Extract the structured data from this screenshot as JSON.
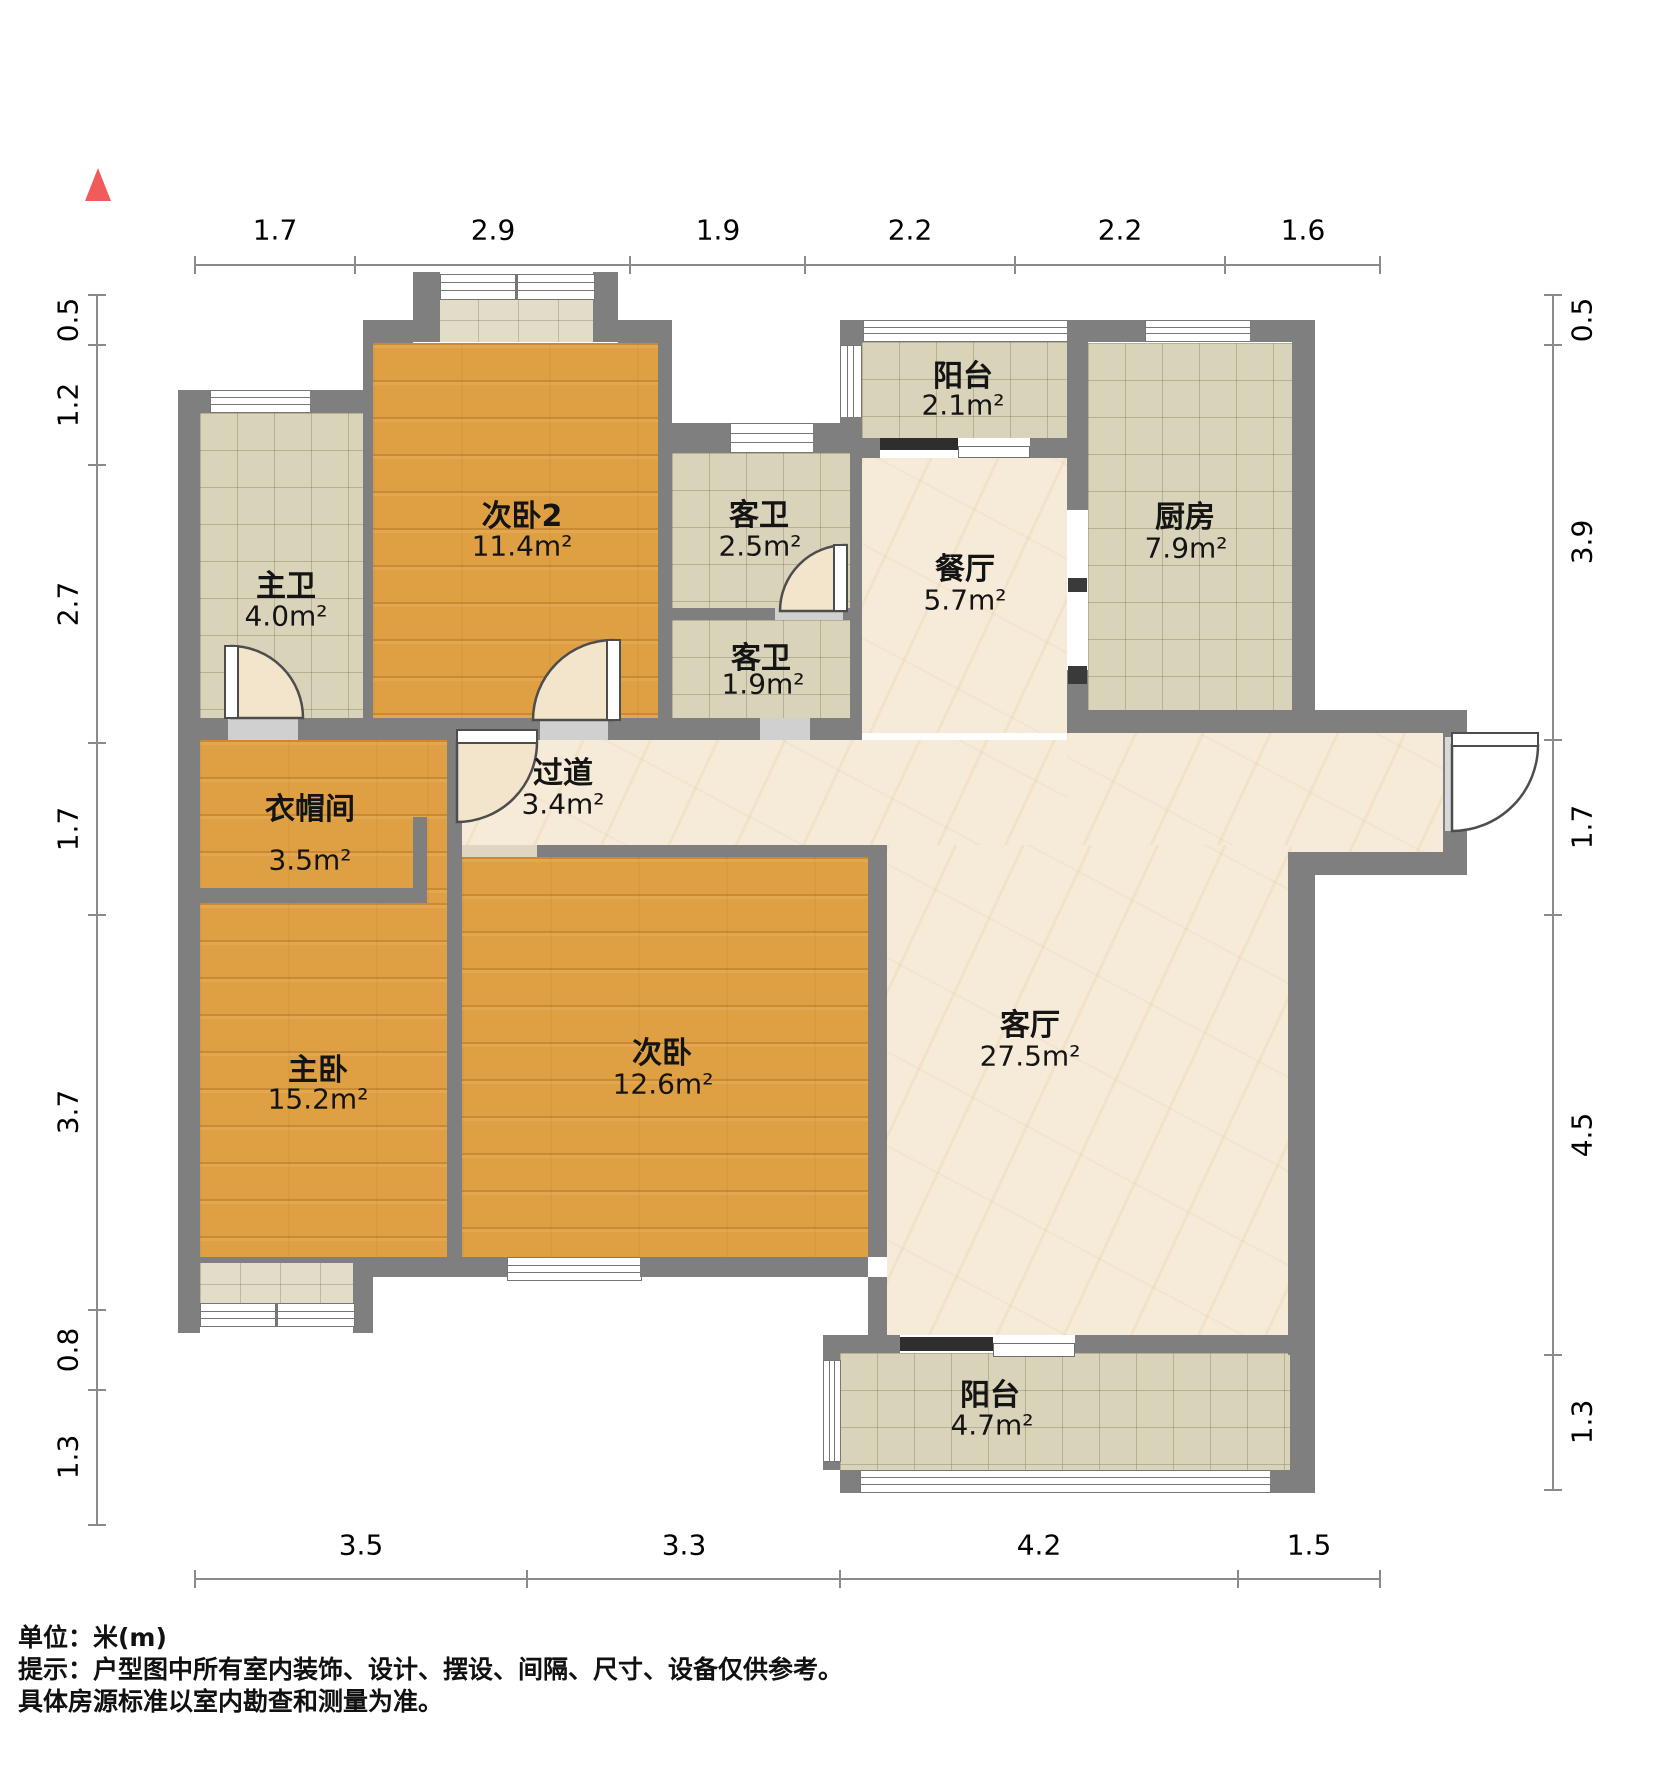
{
  "north_indicator": "north-arrow",
  "rooms": [
    {
      "id": "bedroom2",
      "name": "次卧2",
      "area": "11.4m²"
    },
    {
      "id": "master-bath",
      "name": "主卫",
      "area": "4.0m²"
    },
    {
      "id": "guest-bath-1",
      "name": "客卫",
      "area": "2.5m²"
    },
    {
      "id": "guest-bath-2",
      "name": "客卫",
      "area": "1.9m²"
    },
    {
      "id": "balcony-top",
      "name": "阳台",
      "area": "2.1m²"
    },
    {
      "id": "kitchen",
      "name": "厨房",
      "area": "7.9m²"
    },
    {
      "id": "dining",
      "name": "餐厅",
      "area": "5.7m²"
    },
    {
      "id": "hallway",
      "name": "过道",
      "area": "3.4m²"
    },
    {
      "id": "closet",
      "name": "衣帽间",
      "area": "3.5m²"
    },
    {
      "id": "master-bedroom",
      "name": "主卧",
      "area": "15.2m²"
    },
    {
      "id": "bedroom",
      "name": "次卧",
      "area": "12.6m²"
    },
    {
      "id": "living",
      "name": "客厅",
      "area": "27.5m²"
    },
    {
      "id": "balcony-bottom",
      "name": "阳台",
      "area": "4.7m²"
    }
  ],
  "dimensions": {
    "top": [
      "1.7",
      "2.9",
      "1.9",
      "2.2",
      "2.2",
      "1.6"
    ],
    "bottom": [
      "3.5",
      "3.3",
      "4.2",
      "1.5"
    ],
    "left": [
      "0.5",
      "1.2",
      "2.7",
      "1.7",
      "3.7",
      "0.8",
      "1.3"
    ],
    "right": [
      "0.5",
      "3.9",
      "1.7",
      "4.5",
      "1.3"
    ]
  },
  "notes": {
    "unit": "单位：米(m)",
    "tip1": "提示：户型图中所有室内装饰、设计、摆设、间隔、尺寸、设备仅供参考。",
    "tip2": "具体房源标准以室内勘查和测量为准。"
  },
  "colors": {
    "wall": "#7f7f7f",
    "wood_floor": "#dfa043",
    "tile_floor": "#d8d3b9",
    "marble_floor": "#f6ebd8",
    "bay_sill": "#e2ddc8",
    "door_swing": "#f3e5cc",
    "north_arrow": "#f15b5b",
    "dimension_line": "#8a8a8a"
  }
}
